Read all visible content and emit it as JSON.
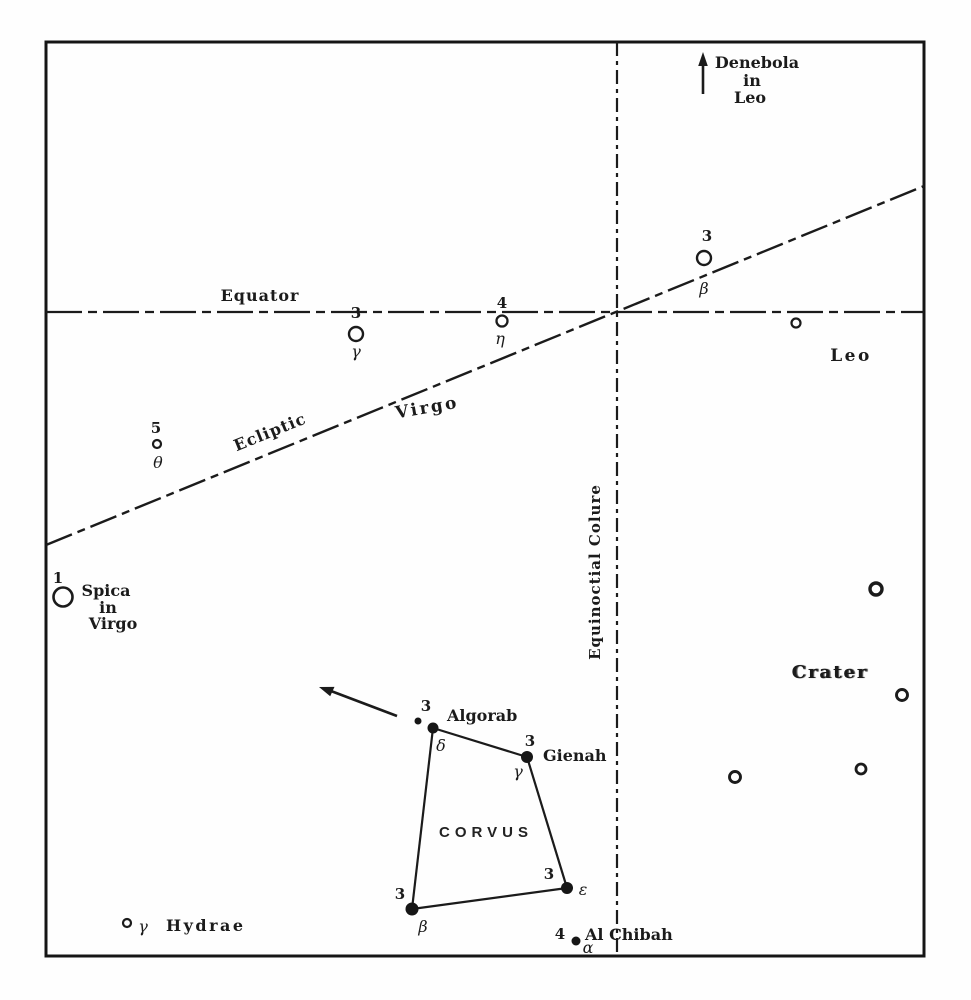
{
  "figure": {
    "ink_color": "#1b1b1b",
    "paper_color": "#fefefe"
  },
  "reference_lines": {
    "equator": "Equator",
    "ecliptic": "Ecliptic",
    "colure": "Equinoctial Colure"
  },
  "constellations": {
    "virgo": "Virgo",
    "leo": "Leo",
    "crater": "Crater",
    "corvus": "CORVUS"
  },
  "direction_note": {
    "line1": "Denebola",
    "line2": "in",
    "line3": "Leo"
  },
  "stars": {
    "spica": {
      "magnitude": "1",
      "name_line1": "Spica",
      "name_line2": "in",
      "name_line3": "Virgo"
    },
    "theta_virginis": {
      "magnitude": "5",
      "greek": "θ"
    },
    "gamma_virginis": {
      "magnitude": "3",
      "greek": "γ"
    },
    "eta_virginis": {
      "magnitude": "4",
      "greek": "η"
    },
    "beta_virginis": {
      "magnitude": "3",
      "greek": "β"
    },
    "algorab": {
      "magnitude": "3",
      "greek": "δ",
      "name": "Algorab"
    },
    "gienah": {
      "magnitude": "3",
      "greek": "γ",
      "name": "Gienah"
    },
    "epsilon_corvi": {
      "magnitude": "3",
      "greek": "ε"
    },
    "beta_corvi": {
      "magnitude": "3",
      "greek": "β"
    },
    "al_chibah": {
      "magnitude": "4",
      "greek": "α",
      "name": "Al Chibah"
    },
    "gamma_hydrae": {
      "greek": "γ",
      "name": "Hydrae"
    }
  }
}
